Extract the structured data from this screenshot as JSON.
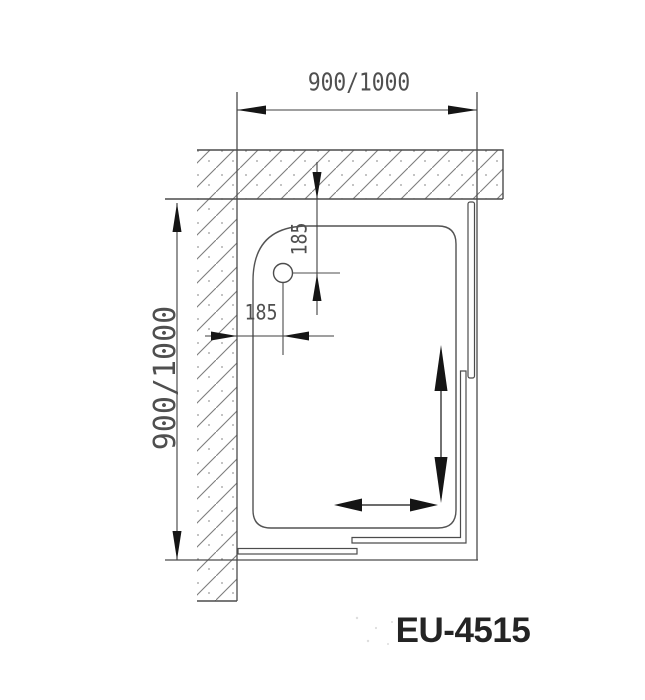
{
  "drawing": {
    "model": "EU-4515",
    "dim_top": "900/1000",
    "dim_left": "900/1000",
    "dim_drain_vertical": "185",
    "dim_drain_horizontal": "185"
  },
  "colors": {
    "background": "#ffffff",
    "structure_line": "#4c4c4c",
    "dimension_line": "#3f3f3f",
    "arrow_fill": "#151515",
    "hatch_line": "#7d7d7d",
    "hatch_dot": "#999999",
    "dim_text": "#4f4f4f",
    "model_text": "#242424"
  }
}
